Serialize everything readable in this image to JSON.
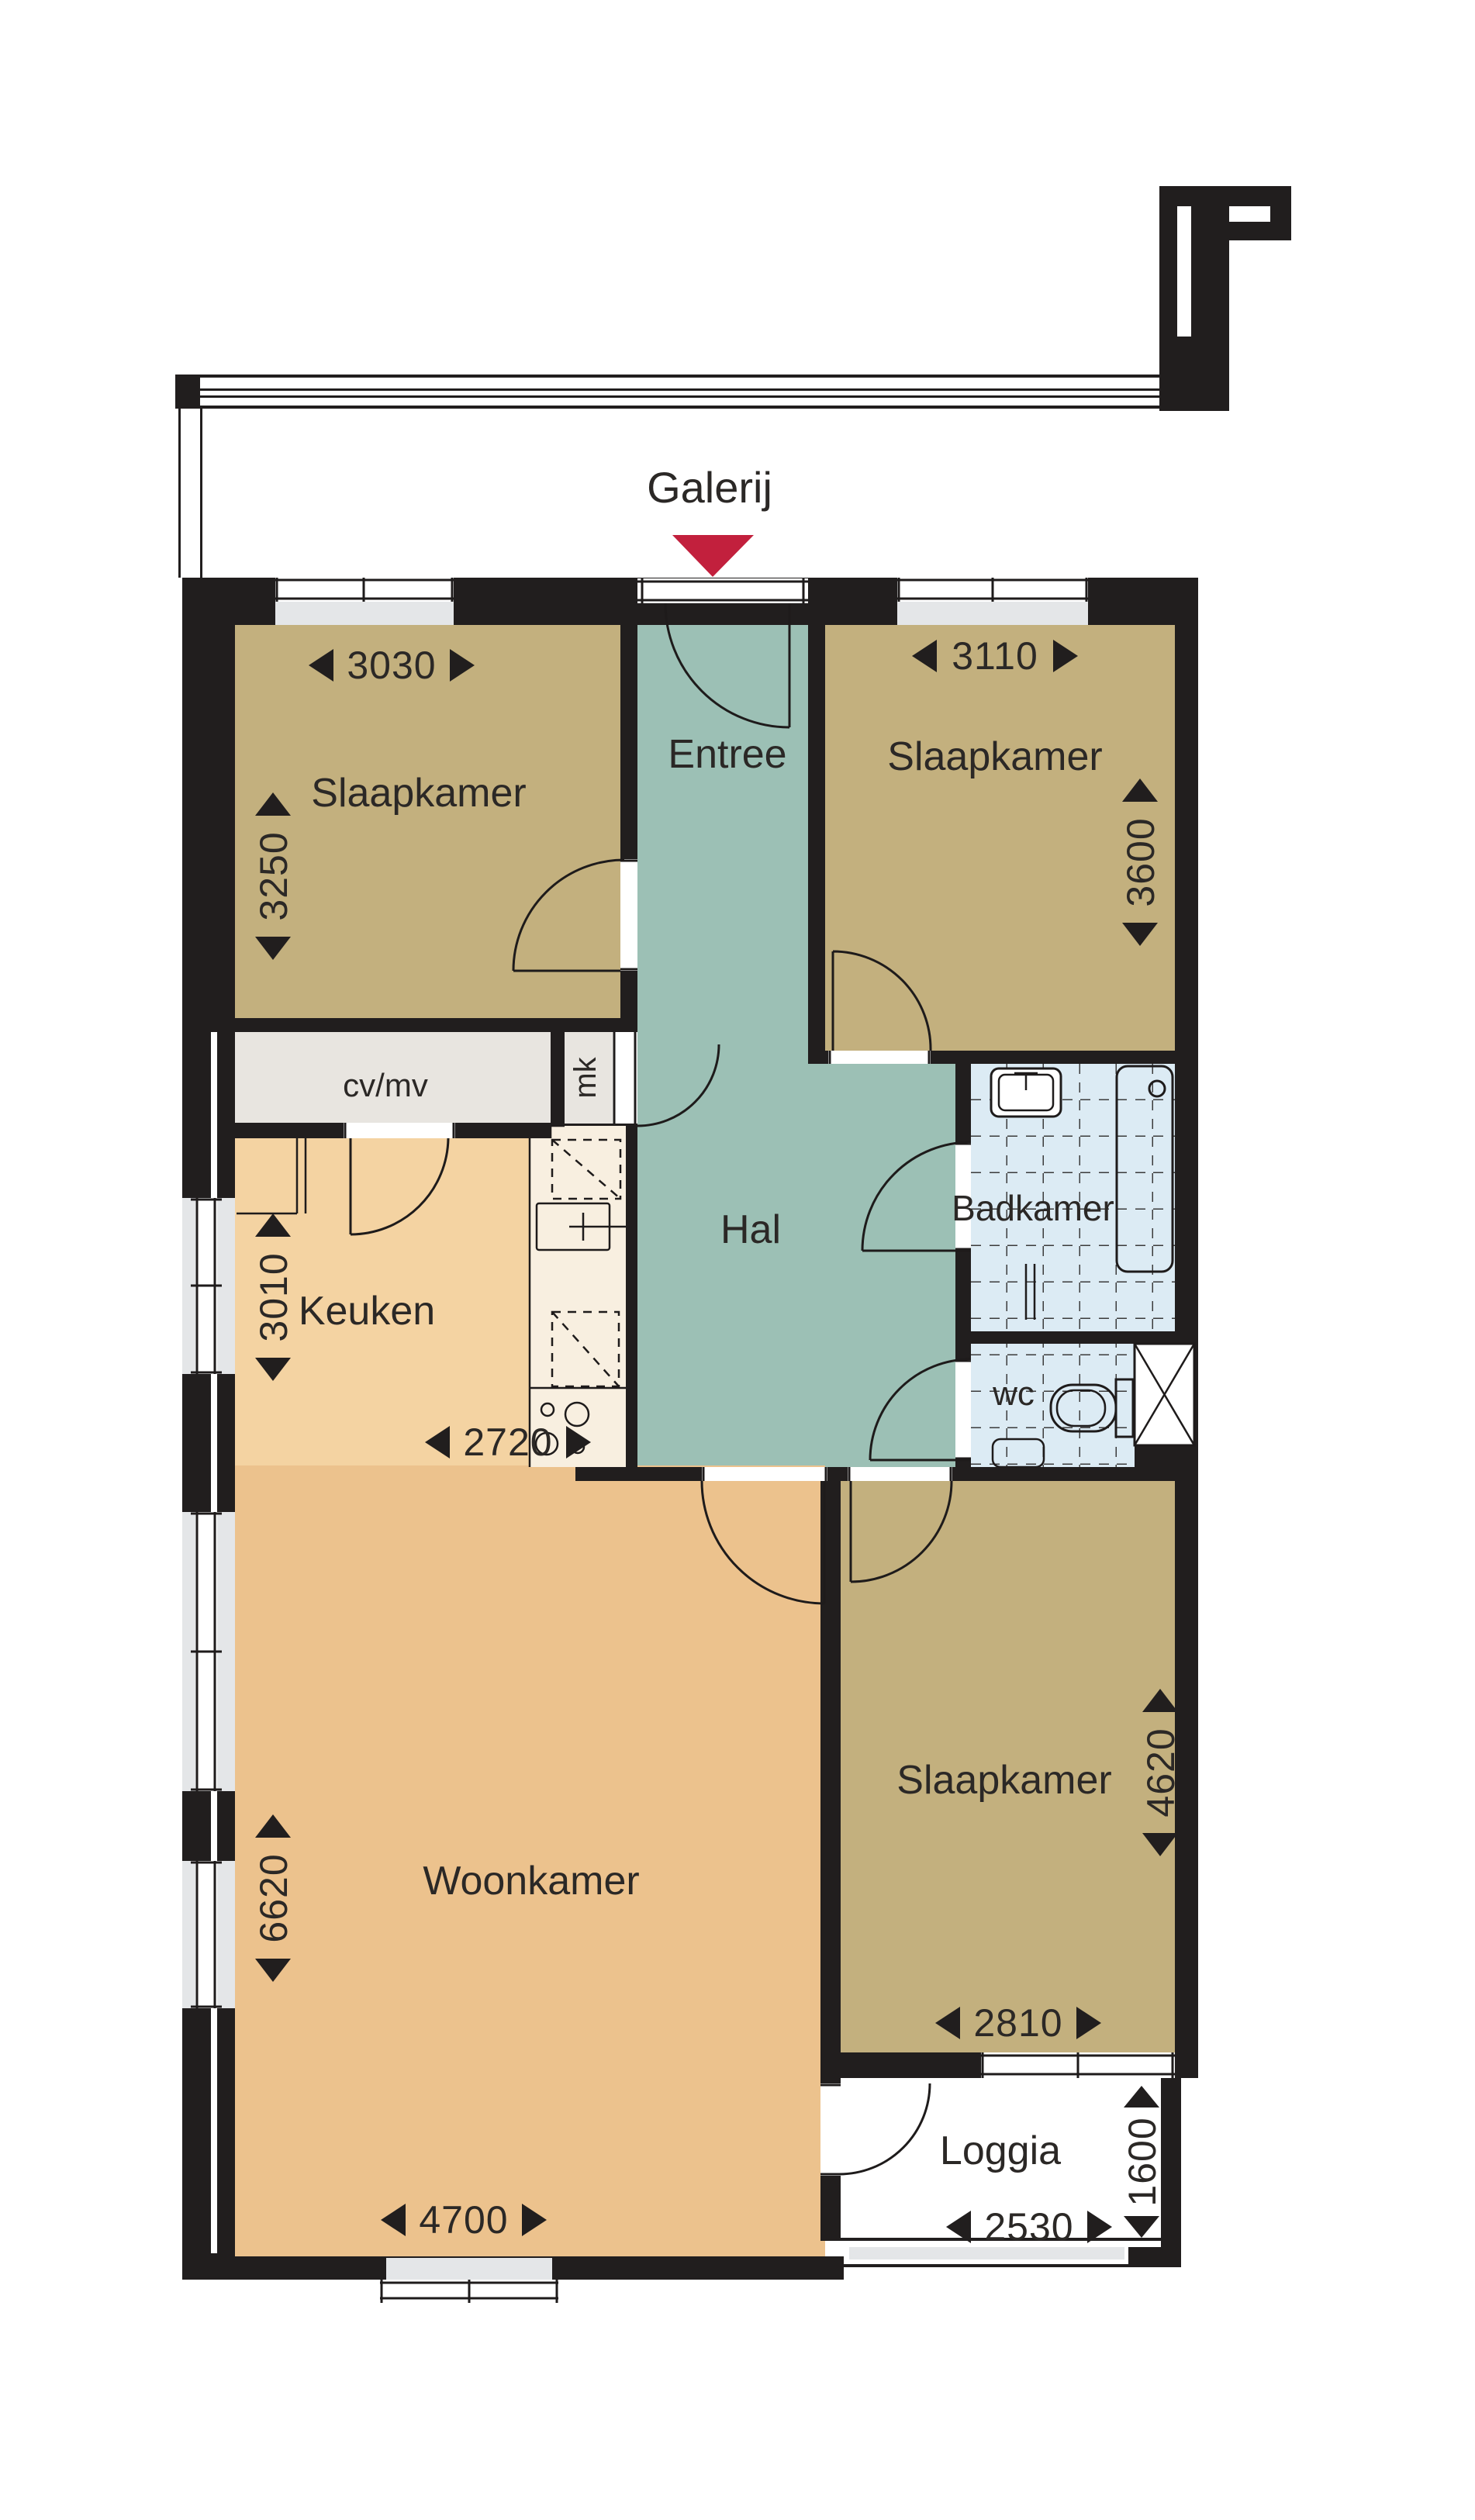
{
  "title": "Galerij",
  "labels": {
    "galerij": "Galerij",
    "entree": "Entree",
    "hal": "Hal",
    "badkamer": "Badkamer",
    "keuken": "Keuken",
    "woonkamer": "Woonkamer",
    "loggia": "Loggia",
    "wc": "wc",
    "cv_mv": "cv/mv",
    "mk": "mk",
    "slaapkamer_topleft": "Slaapkamer",
    "slaapkamer_topright": "Slaapkamer",
    "slaapkamer_bottomright": "Slaapkamer"
  },
  "dimensions_mm": {
    "slaapkamer_topleft_width": "3030",
    "slaapkamer_topleft_depth": "3250",
    "slaapkamer_topright_width": "3110",
    "slaapkamer_topright_depth": "3600",
    "keuken_depth": "3010",
    "keuken_width": "2720",
    "woonkamer_depth": "6620",
    "woonkamer_width": "4700",
    "slaapkamer_bottomright_depth": "4620",
    "slaapkamer_bottomright_width": "2810",
    "loggia_depth": "1600",
    "loggia_width": "2530"
  },
  "colors": {
    "wall": "#211E1E",
    "bedroom_floor": "#C3B07E",
    "hall_floor": "#9CC0B5",
    "kitchen_floor": "#F4D3A2",
    "living_floor": "#ECC28D",
    "bath_floor": "#DCEBF4",
    "utility_floor": "#E8E5E0",
    "counter": "#F8EFE0",
    "window_sill": "#E4E6E8",
    "loggia_floor": "#FFFFFF",
    "tub_fill": "#E9F2F8",
    "arrow_red": "#C2203D",
    "line": "#1E1B1B",
    "text": "#2B2826"
  }
}
